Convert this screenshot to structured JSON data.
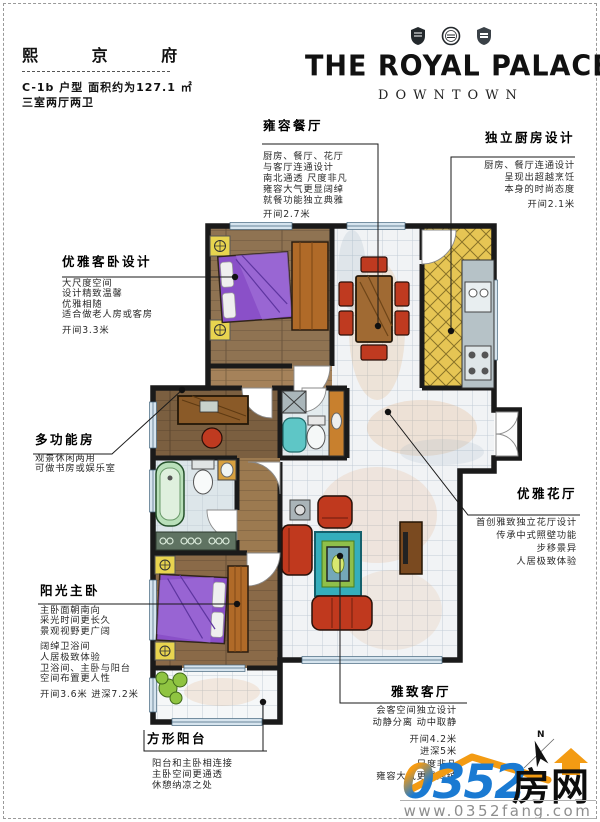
{
  "header": {
    "project_name": "熙 京 府",
    "spec_line1": "C-1b 户型  面积约为127.1 ㎡",
    "spec_line2": "三室两厅两卫",
    "brand_title": "THE ROYAL PALACE",
    "brand_subtitle": "DOWNTOWN",
    "emblem_icons": [
      "shield-emblem",
      "round-seal-emblem",
      "crest-emblem"
    ]
  },
  "annotations": {
    "dining": {
      "title": "雍容餐厅",
      "lines": [
        "厨房、餐厅、花厅",
        "与客厅连通设计",
        "南北通透 尺度非凡",
        "雍容大气更显阔绰",
        "就餐功能独立典雅"
      ],
      "dim": "开间2.7米"
    },
    "kitchen": {
      "title": "独立厨房设计",
      "lines": [
        "厨房、餐厅连通设计",
        "呈现出超越烹饪",
        "本身的时尚态度"
      ],
      "dim": "开间2.1米"
    },
    "guest_bedroom": {
      "title": "优雅客卧设计",
      "lines": [
        "大尺度空间",
        "设计精致温馨",
        "优雅相随",
        "适合做老人房或客房"
      ],
      "dim": "开间3.3米"
    },
    "multi_room": {
      "title": "多功能房",
      "lines": [
        "观景休闲两用",
        "可做书房或娱乐室"
      ]
    },
    "master_bedroom": {
      "title": "阳光主卧",
      "lines": [
        "主卧面朝南向",
        "采光时间更长久",
        "景观视野更广阔"
      ],
      "lines2": [
        "阔绰卫浴间",
        "人居极致体验",
        "卫浴间、主卧与阳台",
        "空间布置更人性"
      ],
      "dim": "开间3.6米  进深7.2米"
    },
    "balcony": {
      "title": "方形阳台",
      "lines": [
        "阳台和主卧相连接",
        "主卧空间更通透",
        "休憩纳凉之处"
      ]
    },
    "flower_hall": {
      "title": "优雅花厅",
      "lines": [
        "首创雅致独立花厅设计",
        "传承中式照壁功能",
        "步移景异",
        "人居极致体验"
      ]
    },
    "living_room": {
      "title": "雅致客厅",
      "lines": [
        "会客空间独立设计",
        "动静分离 动中取静"
      ],
      "dims": [
        "开间4.2米",
        "进深5米",
        "尺度非凡",
        "雍容大气更显阔绰"
      ]
    }
  },
  "footer": {
    "logo_number": "0352",
    "logo_number_first": "0",
    "logo_number_rest": "352",
    "logo_cn": "房网",
    "url": "www.0352fang.com",
    "compass_label": "N",
    "colors": {
      "logo_blue": "#1a7ad2",
      "roof_orange": "#f39b13",
      "url_gray": "#8e8e8e"
    }
  }
}
